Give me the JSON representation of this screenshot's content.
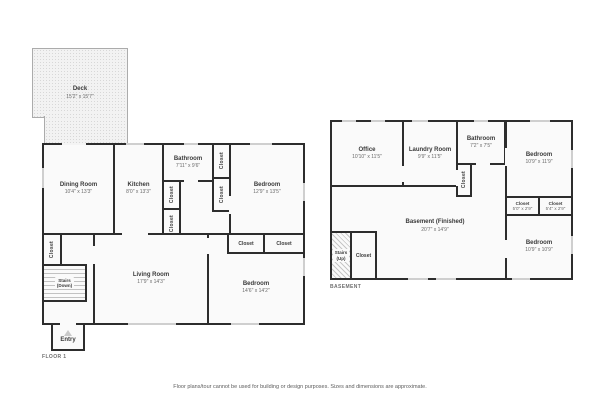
{
  "captions": {
    "floor1": "FLOOR 1",
    "basement": "BASEMENT",
    "disclaimer": "Floor plans/tour cannot be used for building or design purposes. Sizes and dimensions are approximate."
  },
  "labels": {
    "closet": "Closet"
  },
  "colors": {
    "wall": "#2d2d2d",
    "room_fill": "#fafafa",
    "deck_fill": "#f2f2f2",
    "window_mark": "#cfcfcf"
  },
  "floor1": {
    "deck": {
      "name": "Deck",
      "dims": "15'2\" x 15'7\""
    },
    "dining_room": {
      "name": "Dining Room",
      "dims": "10'4\" x 13'3\""
    },
    "kitchen": {
      "name": "Kitchen",
      "dims": "8'0\" x 13'3\""
    },
    "bathroom": {
      "name": "Bathroom",
      "dims": "7'11\" x 9'6\""
    },
    "bedroom_top": {
      "name": "Bedroom",
      "dims": "12'9\" x 13'5\""
    },
    "living_room": {
      "name": "Living Room",
      "dims": "17'9\" x 14'3\""
    },
    "bedroom_bottom": {
      "name": "Bedroom",
      "dims": "14'6\" x 14'2\""
    },
    "stairs": {
      "name": "Stairs",
      "sub": "(Down)"
    },
    "entry": {
      "name": "Entry"
    }
  },
  "basement": {
    "office": {
      "name": "Office",
      "dims": "10'10\" x 11'5\""
    },
    "laundry_room": {
      "name": "Laundry Room",
      "dims": "9'9\" x 11'5\""
    },
    "bathroom": {
      "name": "Bathroom",
      "dims": "7'2\" x 7'5\""
    },
    "bedroom_top": {
      "name": "Bedroom",
      "dims": "10'9\" x 11'9\""
    },
    "closet_left": {
      "name": "Closet",
      "dims": "5'0\" x 2'9\""
    },
    "closet_right": {
      "name": "Closet",
      "dims": "5'4\" x 2'9\""
    },
    "bedroom_bottom": {
      "name": "Bedroom",
      "dims": "10'9\" x 10'9\""
    },
    "main": {
      "name": "Basement (Finished)",
      "dims": "20'7\" x 14'9\""
    },
    "stairs": {
      "name": "Stairs",
      "sub": "(Up)"
    }
  }
}
